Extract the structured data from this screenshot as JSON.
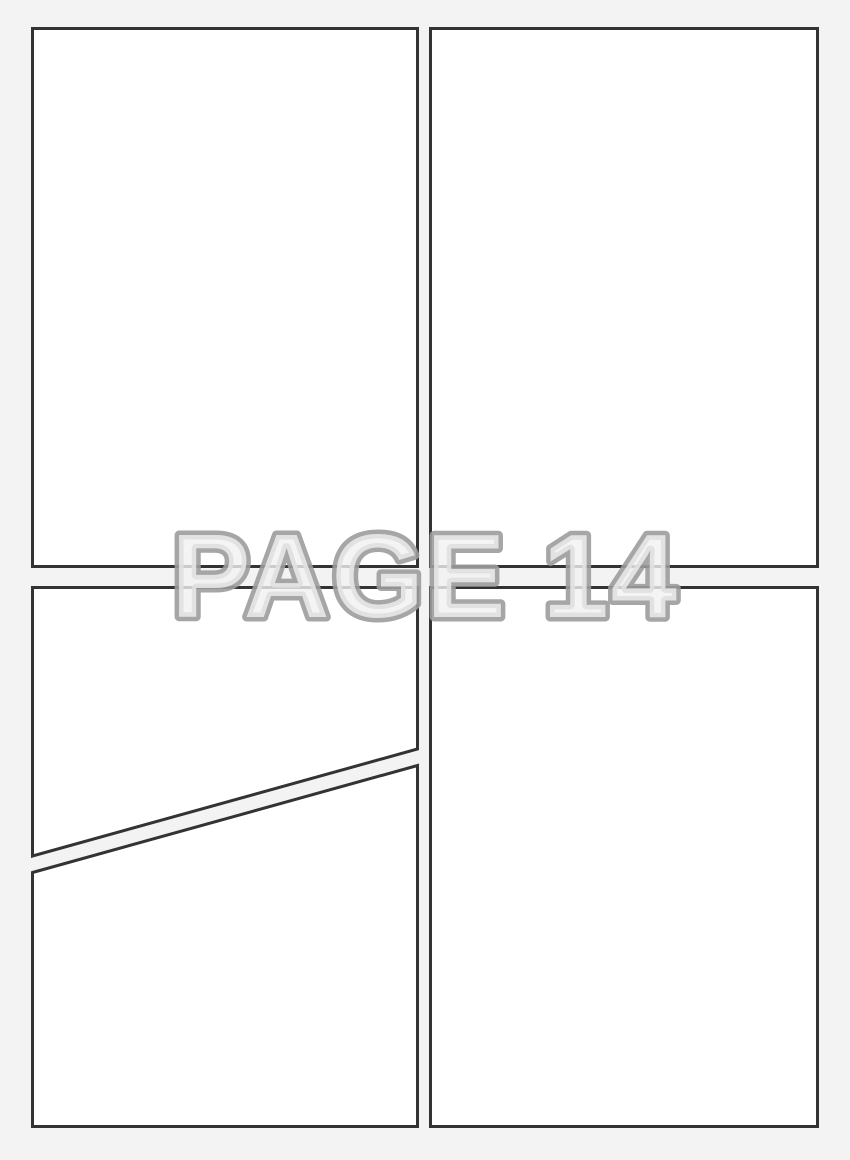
{
  "watermark": {
    "text": "PAGE 14"
  },
  "page": {
    "panel_count": 5
  },
  "colors": {
    "page_background": "#f3f3f3",
    "panel_fill": "#ffffff",
    "panel_border": "#333333",
    "watermark_fill": "#f1f1f1",
    "watermark_outline": "#9c9c9c"
  }
}
